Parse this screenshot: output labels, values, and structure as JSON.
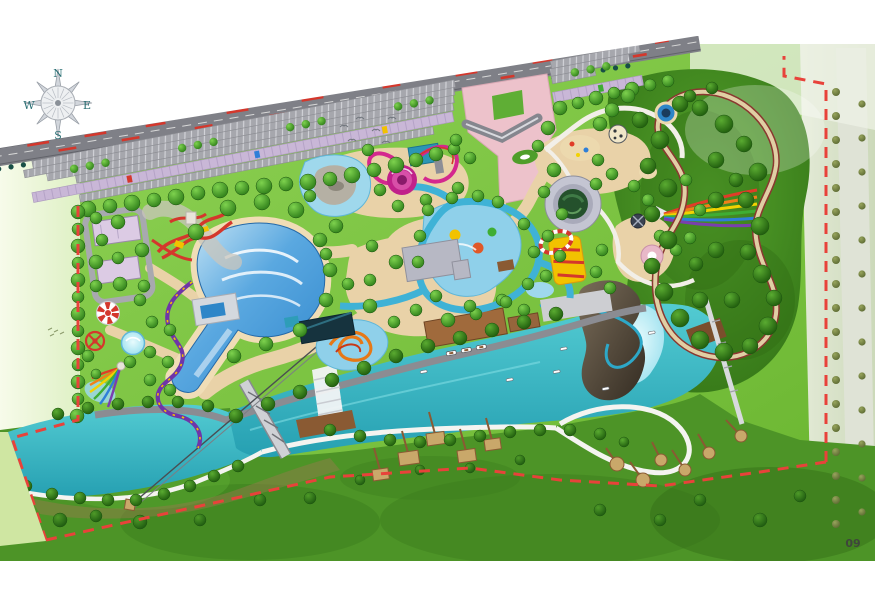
{
  "map": {
    "title_hint": "water-park-master-plan",
    "compass": {
      "north": "N",
      "south": "S",
      "east": "E",
      "west": "W"
    },
    "page_number": "09"
  },
  "palette": {
    "water_teal": "#2fb3bd",
    "wave_pool_blue": "#2f86cc",
    "kids_pool_blue": "#8fd0ea",
    "lagoon_blue": "#a9e6f2",
    "lawn_green": "#79c13d",
    "forest_green": "#3c7d1d",
    "sand_path": "#e9d2a8",
    "beach_sand": "#f0ddb6",
    "parking_gray": "#a6a7ad",
    "road_gray": "#7f8087",
    "walkway_lavender": "#c9b7d7",
    "plaza_pink": "#edc2cb",
    "boundary_red": "#e8423a",
    "slide_magenta": "#d4288e",
    "coaster_purple": "#6f35a8",
    "slide_red": "#d4372c",
    "slide_orange": "#e67817",
    "deck_brown": "#96653c",
    "pad_tan": "#c9a86a",
    "rock_dark": "#3a3228",
    "rainbow": [
      "#e03c28",
      "#f08018",
      "#f2d200",
      "#3fae34",
      "#2e7fd8",
      "#7a3fae"
    ]
  },
  "features": [
    "compass-rose",
    "highway",
    "parking-lot",
    "lavender-walkway",
    "entrance-plaza",
    "gate-structure",
    "service-buildings",
    "wave-pool",
    "tornado-slide",
    "racing-slides",
    "water-coaster",
    "carousel",
    "spinner-ride",
    "rainbow-kids-slide",
    "kids-rock-pool",
    "kids-splash-pool",
    "orange-slide-pool",
    "lazy-river",
    "round-pavilion",
    "tiger-slide-tower",
    "rainbow-racer",
    "forest-loop-track",
    "rock-mountain",
    "lagoon-pool",
    "boating-river",
    "west-lake",
    "waterfall",
    "truss-bridge",
    "zipline",
    "boat-dock",
    "timber-deck",
    "boats",
    "camp-pads",
    "meadow",
    "site-boundary",
    "country-road",
    "birds"
  ]
}
